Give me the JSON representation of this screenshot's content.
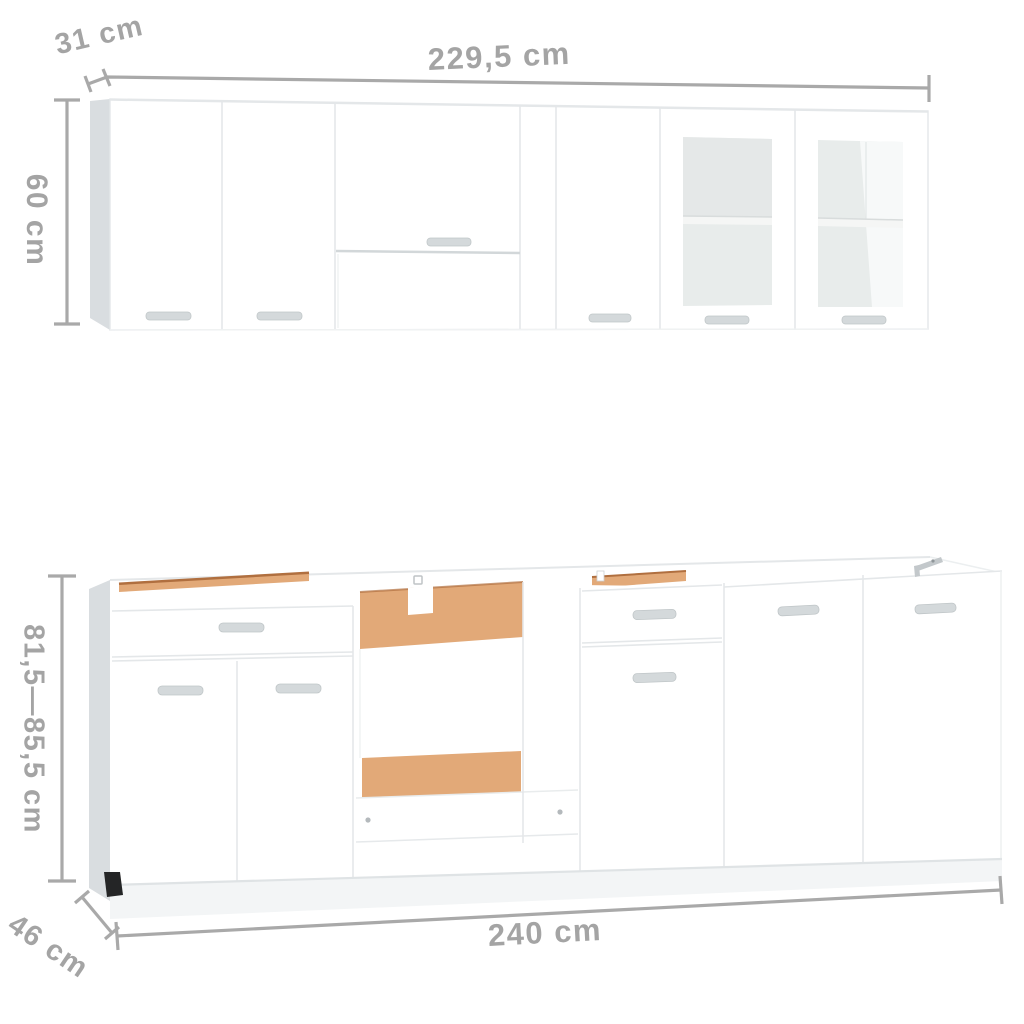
{
  "image": {
    "kind": "kitchen cabinet set dimension illustration",
    "background": "#ffffff"
  },
  "colors": {
    "dim-line": "#a9a9a9",
    "dim-text": "#a4a4a4",
    "cabinet-face": "#ffffff",
    "panel-side": "#d9dde0",
    "gap-line": "#e4e7e9",
    "glass": "#e8eceb",
    "wood": "#e2a978",
    "wood-dark": "#b06f3f",
    "handle": "#d4d9db",
    "plinth": "#f3f5f6",
    "foot": "#242526",
    "bracket": "#c3c8cb"
  },
  "dimensions": {
    "wall_depth": "31 cm",
    "wall_width": "229,5 cm",
    "wall_height": "60 cm",
    "base_height": "81,5—85,5 cm",
    "base_depth": "46 cm",
    "base_width": "240 cm"
  },
  "wall_row": {
    "units": [
      {
        "type": "two-door wall cabinet"
      },
      {
        "type": "over-hood bridge cabinet with opening below"
      },
      {
        "type": "single-door wall cabinet"
      },
      {
        "type": "glass-door wall cabinet with shelf"
      },
      {
        "type": "glass-door wall cabinet with shelf"
      }
    ]
  },
  "base_row": {
    "units": [
      {
        "type": "drawer + two-door base cabinet, open top"
      },
      {
        "type": "open oven housing with wood panels"
      },
      {
        "type": "drawer + door base cabinet, open top"
      },
      {
        "type": "single-door base cabinet"
      },
      {
        "type": "single-door base cabinet"
      }
    ]
  }
}
